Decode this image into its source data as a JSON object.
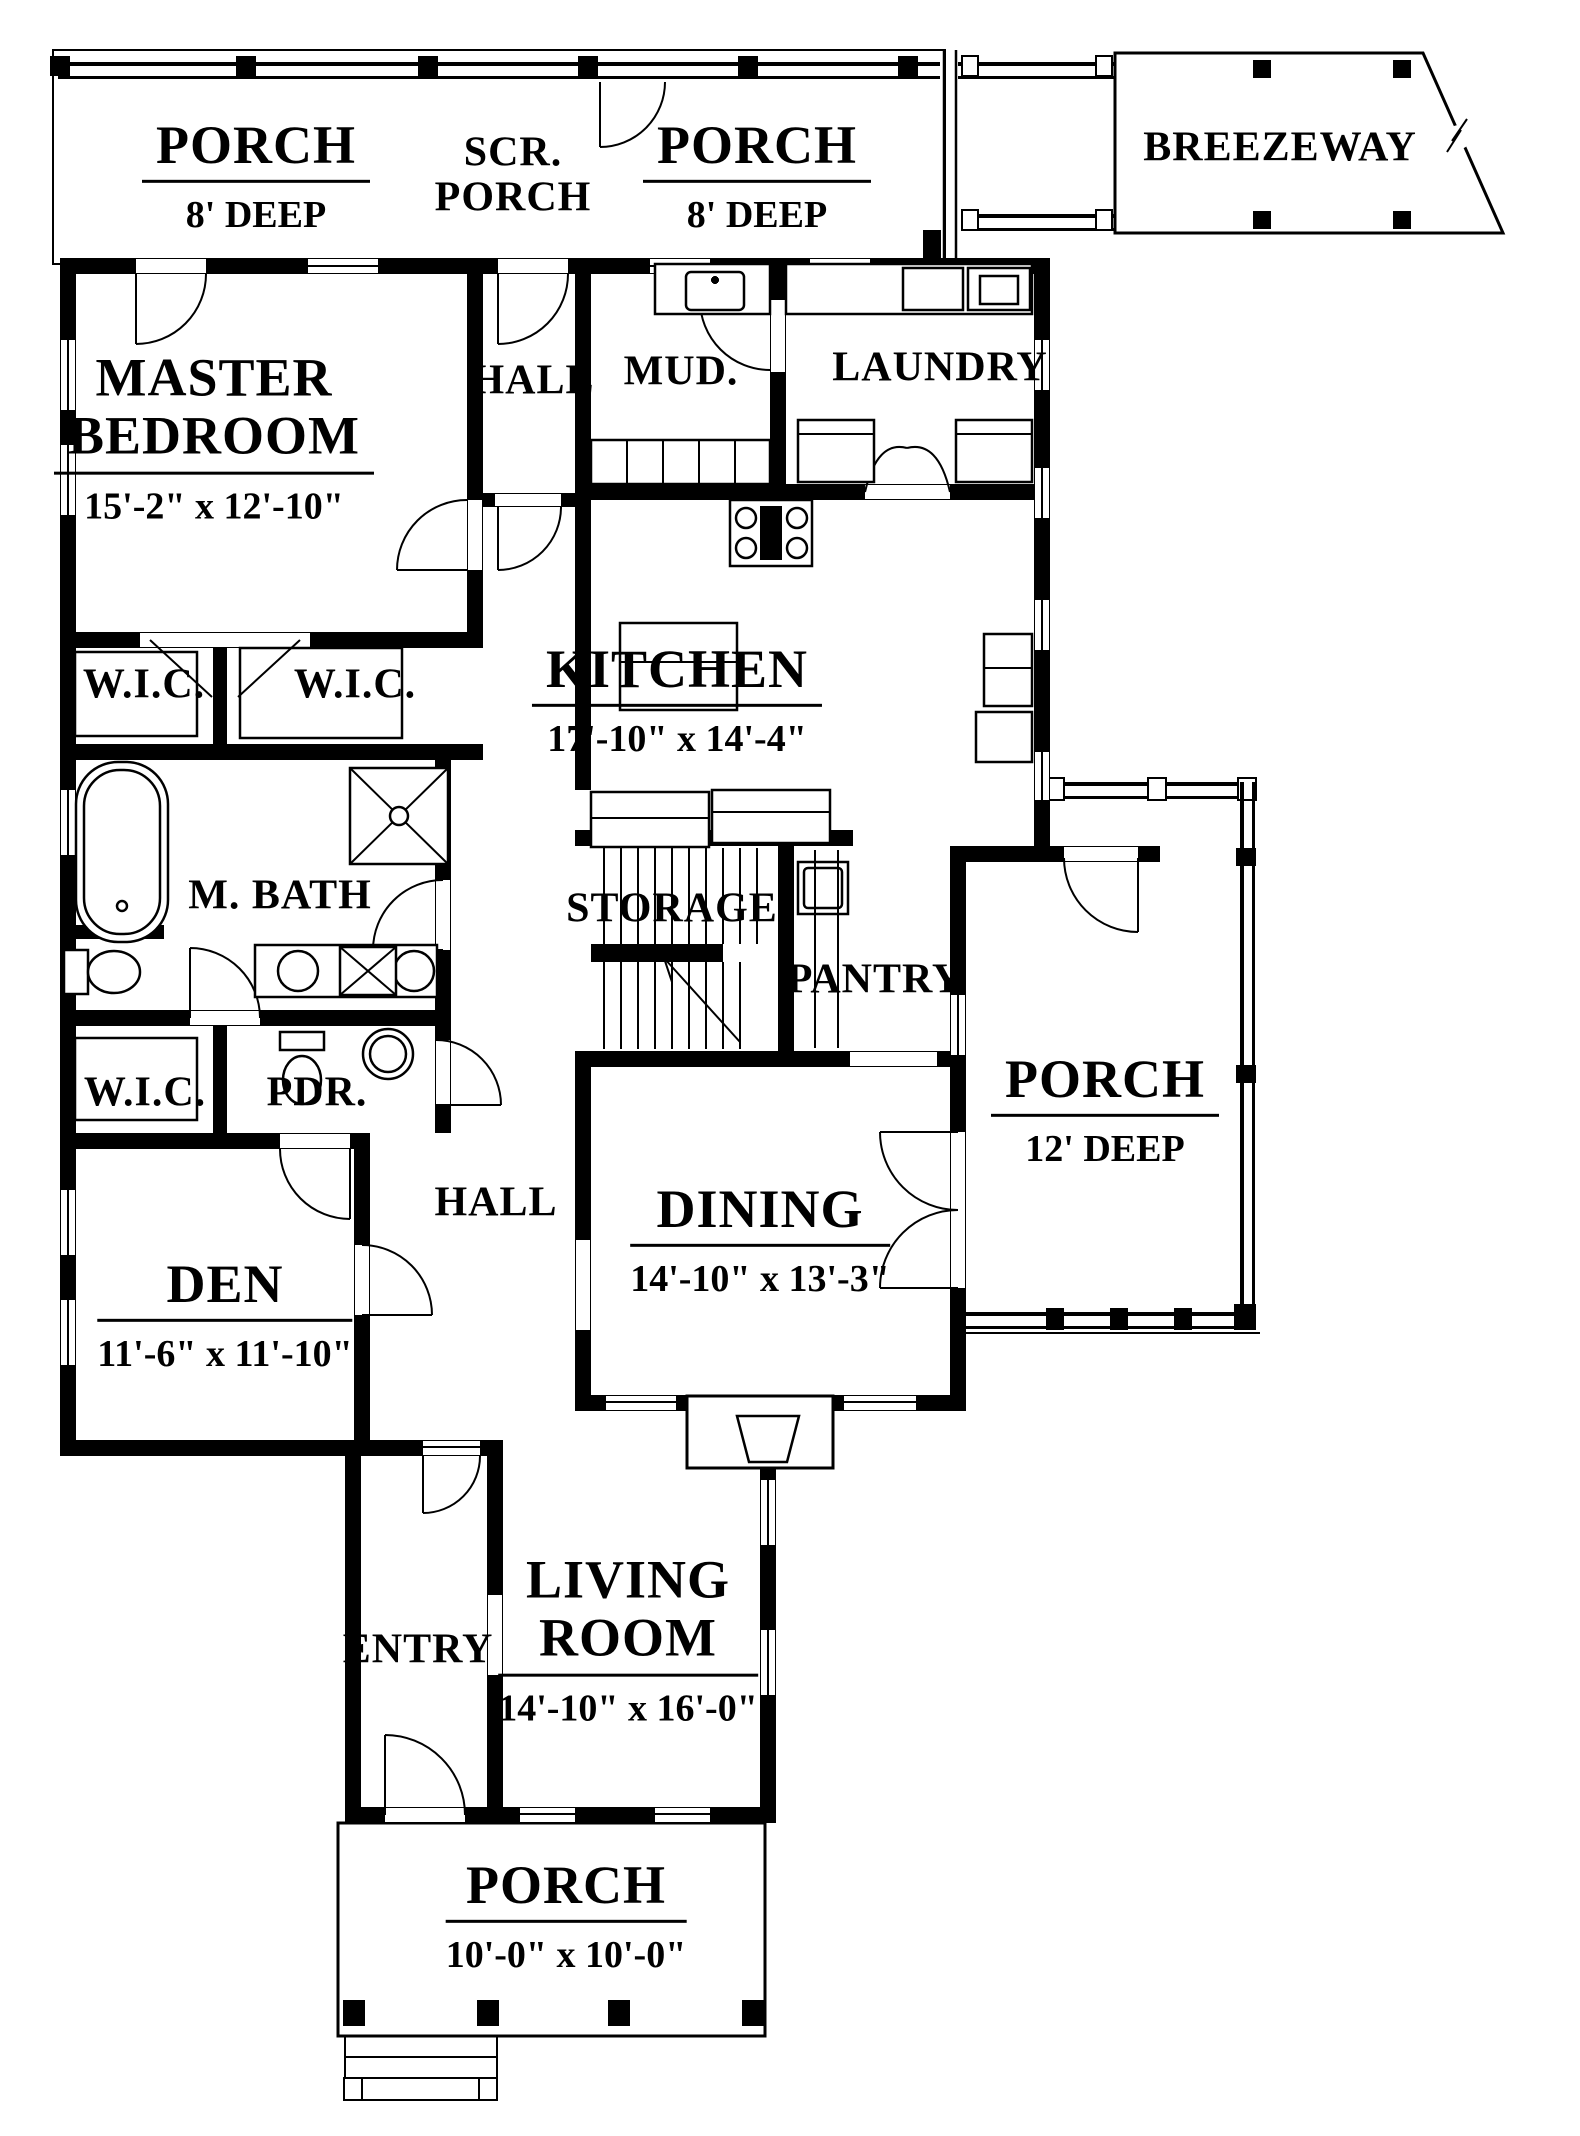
{
  "meta": {
    "ink": "#000000",
    "paper": "#ffffff",
    "drawing_type": "floor plan"
  },
  "rooms": {
    "porch_tl": {
      "name": "PORCH",
      "dims": "8' DEEP"
    },
    "scr_porch": {
      "line1": "SCR.",
      "line2": "PORCH"
    },
    "porch_tr": {
      "name": "PORCH",
      "dims": "8' DEEP"
    },
    "breezeway": {
      "name": "BREEZEWAY"
    },
    "master": {
      "line1": "MASTER",
      "line2": "BEDROOM",
      "dims": "15'-2\" x 12'-10\""
    },
    "hall_upper": {
      "name": "HALL"
    },
    "mud": {
      "name": "MUD."
    },
    "laundry": {
      "name": "LAUNDRY"
    },
    "kitchen": {
      "name": "KITCHEN",
      "dims": "17'-10\" x 14'-4\""
    },
    "wic_left": {
      "name": "W.I.C."
    },
    "wic_right": {
      "name": "W.I.C."
    },
    "mbath": {
      "name": "M. BATH"
    },
    "storage": {
      "name": "STORAGE"
    },
    "pantry": {
      "name": "PANTRY"
    },
    "wic_den": {
      "name": "W.I.C."
    },
    "pdr": {
      "name": "PDR."
    },
    "porch_right": {
      "name": "PORCH",
      "dims": "12' DEEP"
    },
    "hall_lower": {
      "name": "HALL"
    },
    "den": {
      "name": "DEN",
      "dims": "11'-6\" x 11'-10\""
    },
    "dining": {
      "name": "DINING",
      "dims": "14'-10\" x 13'-3\""
    },
    "entry": {
      "name": "ENTRY"
    },
    "living": {
      "line1": "LIVING",
      "line2": "ROOM",
      "dims": "14'-10\" x 16'-0\""
    },
    "porch_bottom": {
      "name": "PORCH",
      "dims": "10'-0\" x 10'-0\""
    }
  }
}
